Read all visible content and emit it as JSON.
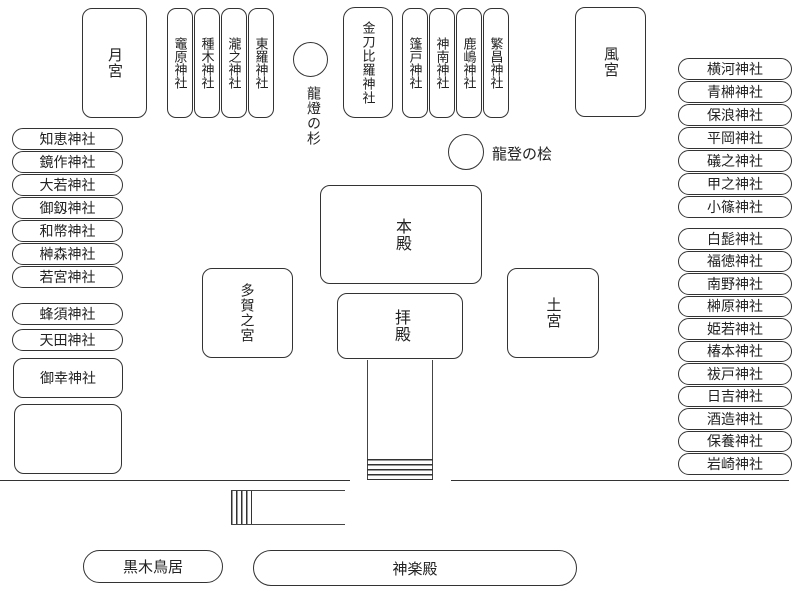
{
  "colors": {
    "line": "#333333",
    "background": "#ffffff"
  },
  "buildings": {
    "tsuki_no_miya": "月宮",
    "kaze_no_miya": "風宮",
    "konpira": "金刀比羅神社",
    "honden": "本殿",
    "haiden": "拝殿",
    "taga_no_miya": "多賀之宮",
    "tsuchi_no_miya": "土宮",
    "goko_jinja": "御幸神社",
    "kuroki_torii": "黒木鳥居",
    "kagura_den": "神楽殿"
  },
  "trees": {
    "ryuto_no_sugi": "龍燈の杉",
    "ryuto_no_hinoki": "龍登の桧"
  },
  "shrine_rows": {
    "top_left": [
      "竈原神社",
      "種木神社",
      "瀧之神社",
      "東羅神社"
    ],
    "top_center": [
      "篷戸神社",
      "神南神社",
      "鹿嶋神社",
      "繁昌神社"
    ]
  },
  "left_column": {
    "group1": [
      "知恵神社",
      "鏡作神社",
      "大若神社",
      "御釼神社",
      "和幣神社",
      "榊森神社",
      "若宮神社"
    ],
    "group2": [
      "蜂須神社",
      "天田神社"
    ]
  },
  "right_column": {
    "group1": [
      "横河神社",
      "青榊神社",
      "保浪神社",
      "平岡神社",
      "礒之神社",
      "甲之神社",
      "小篠神社"
    ],
    "group2": [
      "白髭神社",
      "福徳神社",
      "南野神社",
      "榊原神社",
      "姫若神社",
      "椿本神社",
      "祓戸神社",
      "日吉神社",
      "酒造神社",
      "保養神社",
      "岩崎神社"
    ]
  }
}
